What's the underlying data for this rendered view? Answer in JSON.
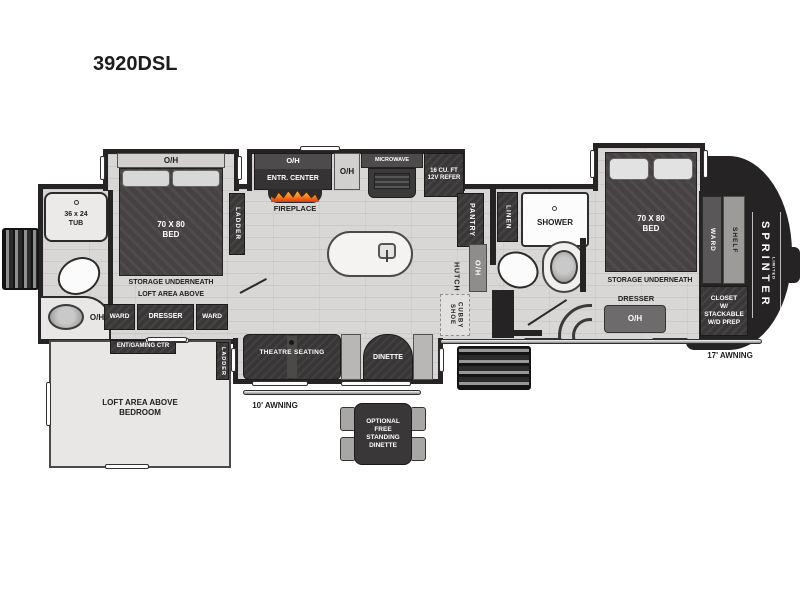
{
  "model": "3920DSL",
  "colors": {
    "wall": "#262324",
    "floor": "#d8d7d5",
    "dark_box": "#3a3738",
    "bench_gray": "#b9b7b5",
    "flame_accent": "#f6821f"
  },
  "front_bath": {
    "tub": "36 x 24\nTUB",
    "sink_oh": "O/H"
  },
  "front_bedroom": {
    "oh": "O/H",
    "bed": "70 X 80\nBED",
    "storage": "STORAGE UNDERNEATH",
    "loft": "LOFT AREA ABOVE",
    "ladder": "LADDER",
    "ward_left": "WARD",
    "dresser": "DRESSER",
    "ward_right": "WARD"
  },
  "kitchen": {
    "entr_oh": "O/H",
    "entr_center": "ENTR. CENTER",
    "fireplace": "FIREPLACE",
    "counter_oh": "O/H",
    "microwave": "MICROWAVE",
    "refer": "16 CU. FT\n12V REFER",
    "pantry": "PANTRY",
    "hutch": "HUTCH",
    "hutch_oh": "O/H",
    "shoe_cubby": "SHOE\nCUBBY"
  },
  "mid_bath": {
    "linen": "LINEN",
    "shower": "SHOWER"
  },
  "rear_bedroom": {
    "bed": "70 X 80\nBED",
    "storage": "STORAGE UNDERNEATH",
    "dresser": "DRESSER",
    "dresser_oh": "O/H",
    "ward": "WARD",
    "shelf": "SHELF",
    "closet": "CLOSET\nW/\nSTACKABLE\nW/D PREP"
  },
  "cap": {
    "brand": "SPRINTER",
    "series": "LIMITED"
  },
  "living": {
    "theatre": "THEATRE SEATING",
    "dinette": "DINETTE"
  },
  "loft": {
    "ent_center": "ENT/GAMING CTR",
    "label": "LOFT AREA ABOVE\nBEDROOM",
    "ladder": "LADDER"
  },
  "exterior": {
    "awning_left": "10' AWNING",
    "awning_right": "17' AWNING"
  },
  "optional": {
    "dinette": "OPTIONAL\nFREE\nSTANDING\nDINETTE"
  }
}
